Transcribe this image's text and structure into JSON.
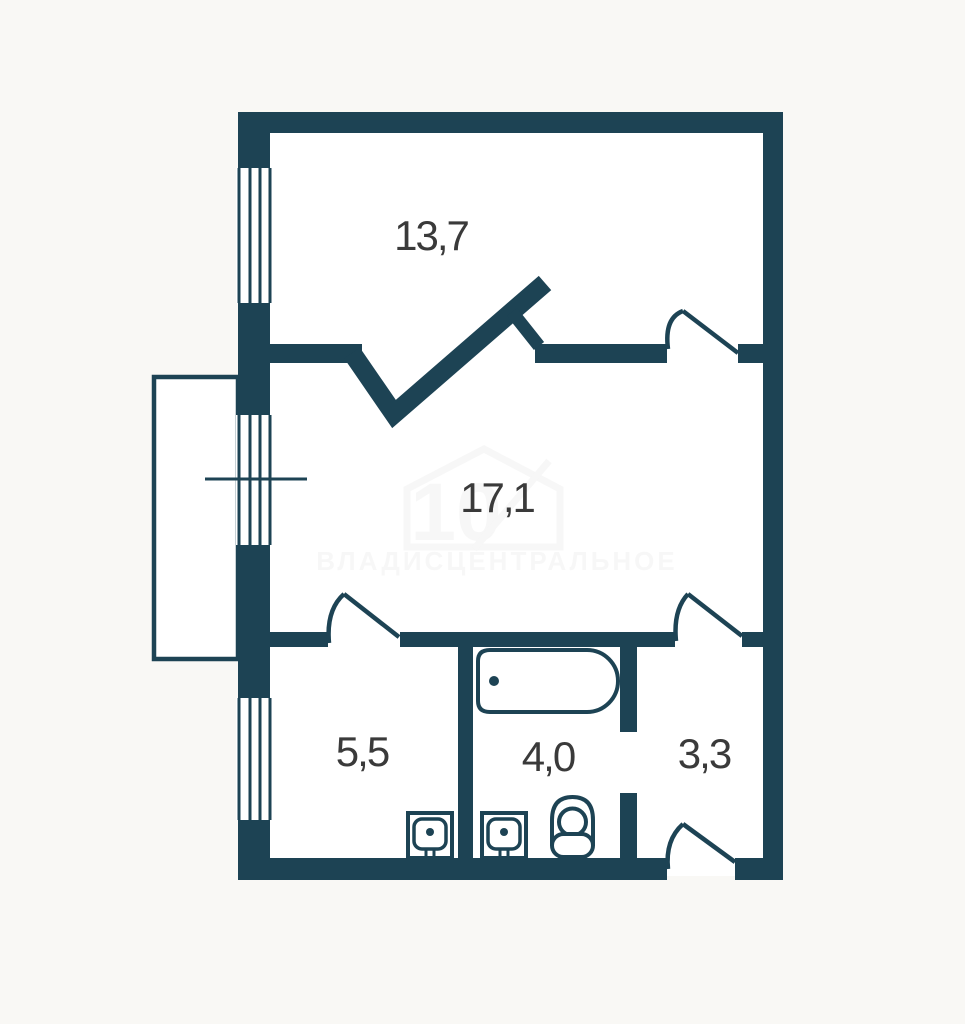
{
  "page": {
    "background": "#f9f8f5"
  },
  "plan": {
    "wall_color": "#1d4354",
    "room_fill": "#ffffff",
    "label_color": "#3a3a3a",
    "rooms": [
      {
        "name": "room-13-7",
        "area_label": "13,7"
      },
      {
        "name": "room-17-1",
        "area_label": "17,1"
      },
      {
        "name": "room-5-5",
        "area_label": "5,5"
      },
      {
        "name": "room-4-0",
        "area_label": "4,0"
      },
      {
        "name": "room-3-3",
        "area_label": "3,3"
      }
    ],
    "watermark": {
      "logo_number": "10",
      "text": "ВЛАДИСЦЕНТРАЛЬНОЕ"
    }
  }
}
